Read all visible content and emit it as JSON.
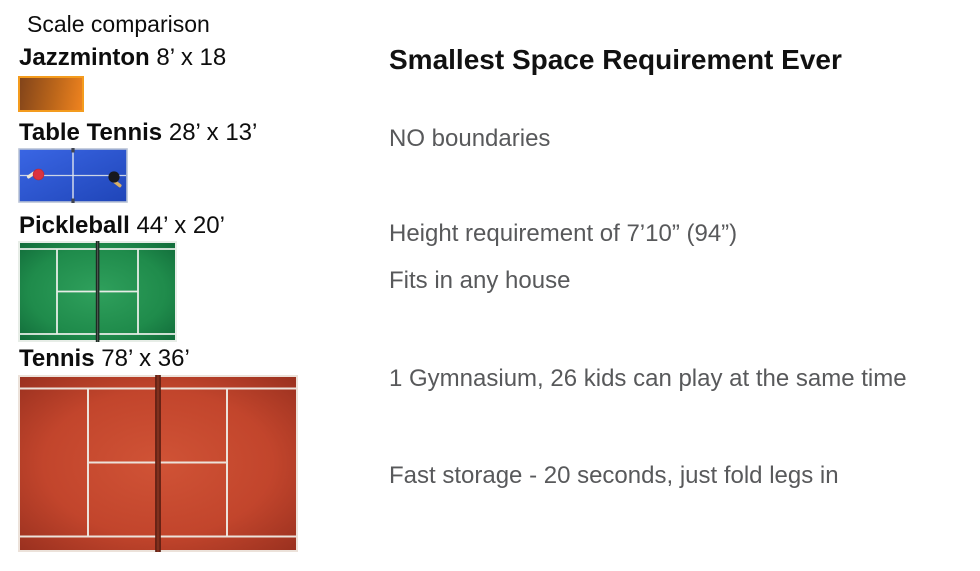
{
  "scale_panel": {
    "title": "Scale comparison",
    "courts": [
      {
        "name": "Jazzminton",
        "dimensions": "8’ x 18"
      },
      {
        "name": "Table Tennis",
        "dimensions": "28’ x 13’"
      },
      {
        "name": "Pickleball",
        "dimensions": "44’ x 20’"
      },
      {
        "name": "Tennis",
        "dimensions": "78’ x 36’"
      }
    ]
  },
  "info_panel": {
    "heading": "Smallest Space Requirement Ever",
    "points": [
      "NO boundaries",
      "Height requirement of 7’10” (94”)",
      "Fits in any house",
      "1 Gymnasium, 26 kids can play at the same time",
      "Fast storage - 20 seconds, just fold legs in"
    ]
  },
  "colors": {
    "heading_text": "#111111",
    "title_text": "#0d0d0d",
    "body_text": "#58595b",
    "jazzminton_orange": "#ef831f",
    "table_tennis_blue": "#2c55d3",
    "pickleball_green": "#1f8b4b",
    "tennis_red": "#c2452c",
    "court_line_white": "#ece2da"
  }
}
